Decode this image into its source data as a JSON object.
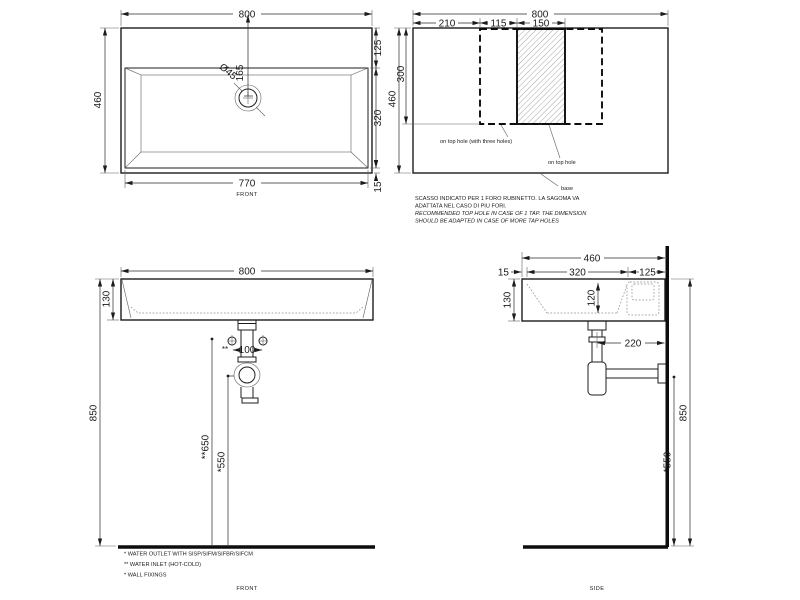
{
  "plan_view": {
    "dim_width": "800",
    "dim_height": "460",
    "dim_back_ledge": "125",
    "dim_bowl": "320",
    "dim_front_rim": "15",
    "dim_inner_width": "770",
    "dim_hole_offset": "165",
    "hole_diameter": "Ø45",
    "label": "FRONT"
  },
  "cutout_view": {
    "dim_width": "800",
    "dim_left": "210",
    "dim_mid": "115",
    "dim_hole_zone": "150",
    "dim_height": "460",
    "dim_cutout_depth": "300",
    "callout_three_holes": "on top hole (with three holes)",
    "callout_one_hole": "on top hole",
    "callout_base": "base",
    "note_line1": "SCASSO INDICATO PER 1 FORO RUBINETTO. LA SAGOMA VA",
    "note_line2": "ADATTATA NEL CASO DI PIU FORI.",
    "note_line3": "RECOMMENDED TOP HOLE IN CASE OF 1 TAP. THE DIMENSION",
    "note_line4": "SHOULD BE ADAPTED IN CASE OF MORE TAP HOLES"
  },
  "front_view": {
    "dim_width": "800",
    "dim_height": "130",
    "dim_inlet_spacing": "100",
    "inlet_mark": "**",
    "dim_total_height": "850",
    "dim_inlet_height": "**650",
    "dim_outlet_height": "*550",
    "legend_line1": "* WATER OUTLET WITH SISP/SIFM/SIFBR/SIFCM",
    "legend_line2": "** WATER INLET  (HOT-COLD)",
    "legend_line3": "* WALL FIXINGS",
    "label": "FRONT"
  },
  "side_view": {
    "dim_depth": "460",
    "dim_front_rim": "15",
    "dim_bowl": "320",
    "dim_back_ledge": "125",
    "dim_height": "130",
    "dim_bowl_depth": "120",
    "dim_trap_offset": "220",
    "dim_total_height": "850",
    "dim_outlet_height": "*550",
    "label": "SIDE"
  }
}
